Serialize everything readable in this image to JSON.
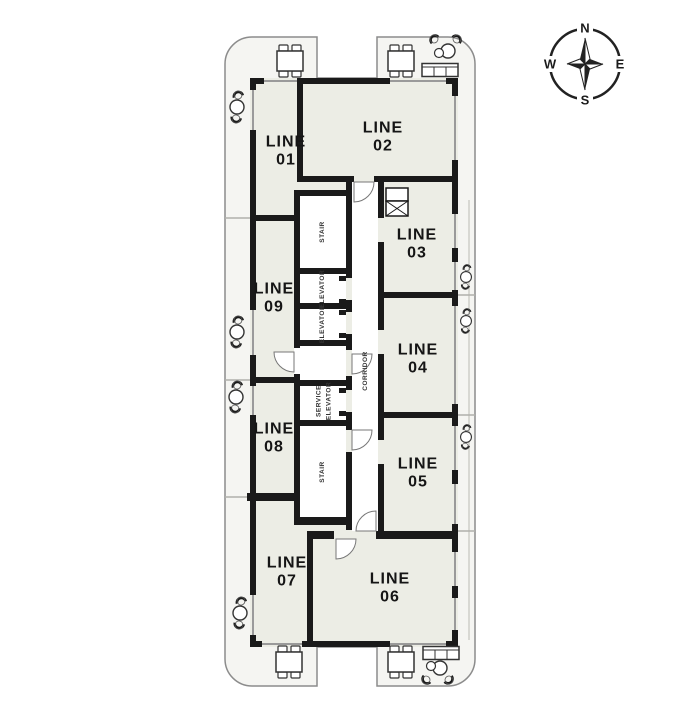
{
  "title": "Residential tower typical floor plan",
  "colors": {
    "wall": "#1a1a1a",
    "room_fill": "#ecede5",
    "balcony_fill": "#f5f5f2",
    "outline": "#8c8c8c",
    "window_line": "#9a9a9a",
    "label_text": "#151515",
    "small_text": "#333333"
  },
  "units": [
    {
      "id": "01",
      "label": "LINE\n01"
    },
    {
      "id": "02",
      "label": "LINE\n02"
    },
    {
      "id": "03",
      "label": "LINE\n03"
    },
    {
      "id": "04",
      "label": "LINE\n04"
    },
    {
      "id": "05",
      "label": "LINE\n05"
    },
    {
      "id": "06",
      "label": "LINE\n06"
    },
    {
      "id": "07",
      "label": "LINE\n07"
    },
    {
      "id": "08",
      "label": "LINE\n08"
    },
    {
      "id": "09",
      "label": "LINE\n09"
    }
  ],
  "core": {
    "stair_top": "STAIR",
    "elevator_1": "ELEVATOR",
    "elevator_2": "ELEVATOR",
    "service_elevator": "SERVICE\nELEVATOR",
    "stair_bottom": "STAIR",
    "corridor": "CORRIDOR"
  },
  "compass": {
    "north": "N",
    "east": "E",
    "south": "S",
    "west": "W"
  },
  "icons": {
    "compass-rose": "four point star in circle",
    "dining-table": "rectangle table with four chairs",
    "patio-set": "round table with crescent chairs",
    "sofa": "bench rectangle",
    "shaft": "box with X cross hatch"
  }
}
